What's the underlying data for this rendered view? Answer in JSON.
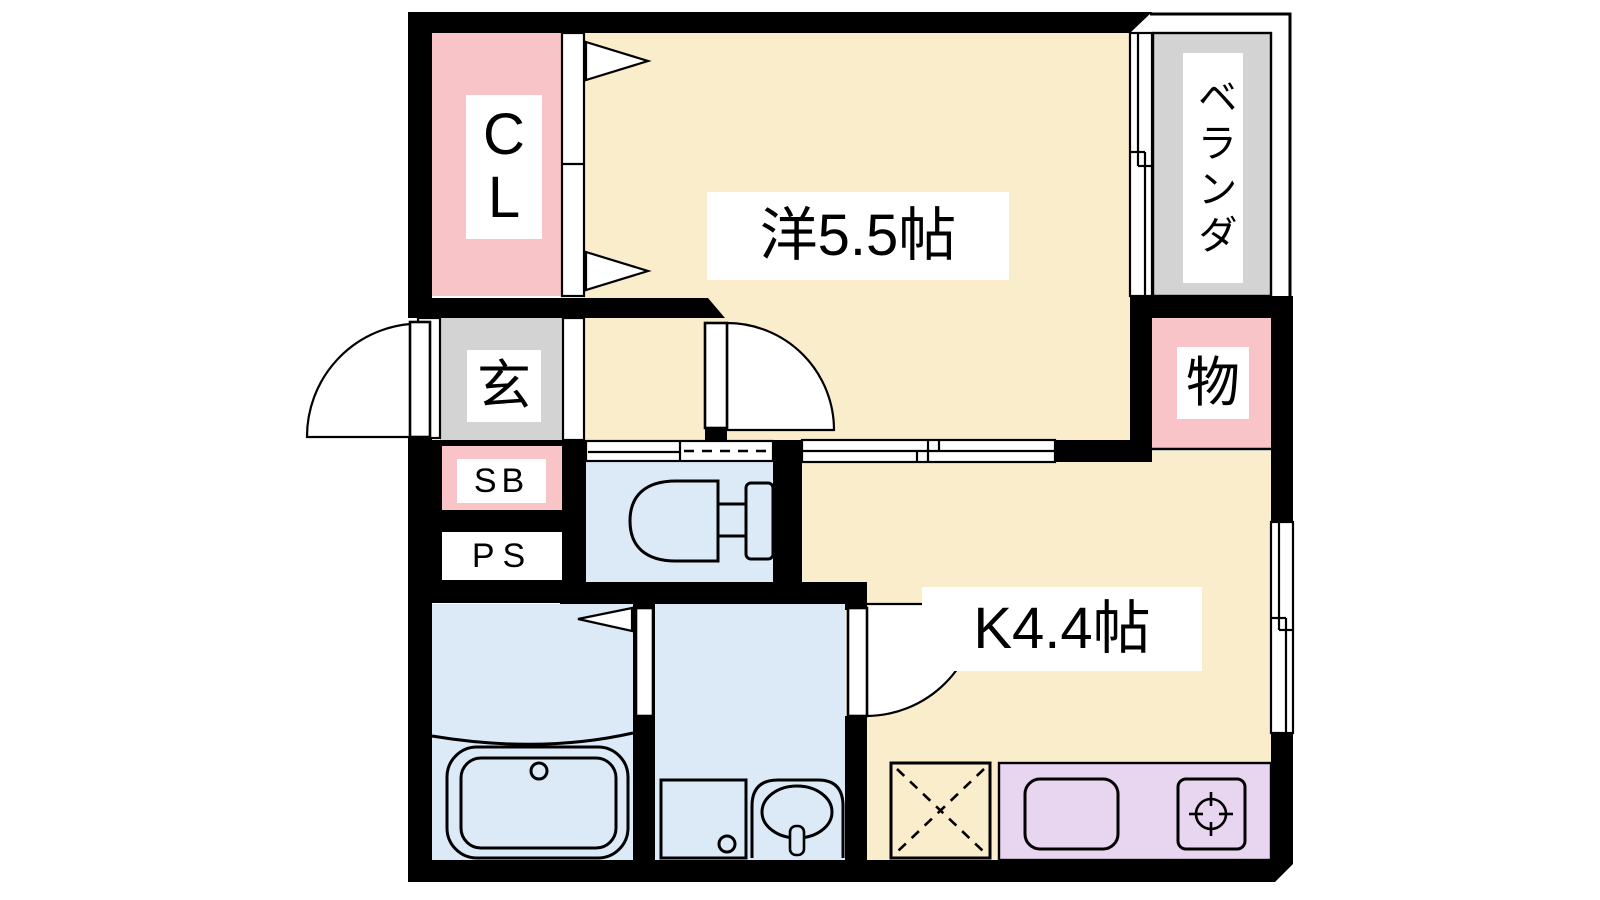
{
  "plan": {
    "title": "1K apartment floor plan",
    "labels": {
      "closet": "C\nL",
      "western_room": "洋5.5帖",
      "veranda": "ベランダ",
      "storage": "物",
      "entrance": "玄",
      "shoe_box": "SB",
      "pipe_space": "PS",
      "kitchen": "K4.4帖"
    },
    "colors": {
      "wall": "#000000",
      "room_cream": "#FAEDCC",
      "closet_pink": "#F9C4C8",
      "service_gray": "#D3D3D3",
      "wet_blue": "#DCEAF8",
      "counter_lavender": "#E8D5F0",
      "paper_white": "#FFFFFF"
    },
    "fixture_icons": [
      "entrance-door-swing-icon",
      "folding-door-triangle-icon",
      "sliding-door-icon",
      "sliding-window-icon",
      "toilet-icon",
      "bathtub-icon",
      "washing-machine-pan-icon",
      "wash-basin-icon",
      "kitchen-sink-icon",
      "gas-stove-icon",
      "refrigerator-space-icon"
    ]
  }
}
